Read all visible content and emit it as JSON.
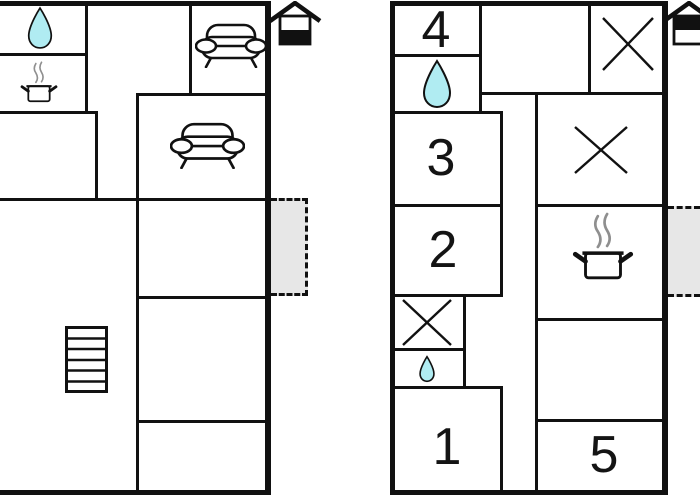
{
  "canvas": {
    "width": 700,
    "height": 500,
    "background": "#ffffff"
  },
  "colors": {
    "wall": "#111111",
    "water_drop_fill": "#b0ecf2",
    "entrance_fill": "#e7e7e7",
    "steam": "#8f8f8f",
    "text": "#141414"
  },
  "plans": [
    {
      "name": "ground-floor",
      "floor_indicator": {
        "icon": "house-floor-indicator",
        "filled_half": "bottom"
      },
      "icons": [
        "water-drop",
        "cooking-pot",
        "sofa",
        "sofa",
        "stairs"
      ],
      "entrance_area": {
        "style": "gray-dashed"
      },
      "rooms": []
    },
    {
      "name": "upper-floor",
      "floor_indicator": {
        "icon": "house-floor-indicator",
        "filled_half": "top"
      },
      "icons": [
        "water-drop",
        "water-drop",
        "cooking-pot",
        "cross",
        "cross",
        "cross"
      ],
      "entrance_area": {
        "style": "gray-dashed"
      },
      "rooms": [
        {
          "number": "4"
        },
        {
          "number": "3"
        },
        {
          "number": "2"
        },
        {
          "number": "1"
        },
        {
          "number": "5"
        }
      ]
    }
  ]
}
